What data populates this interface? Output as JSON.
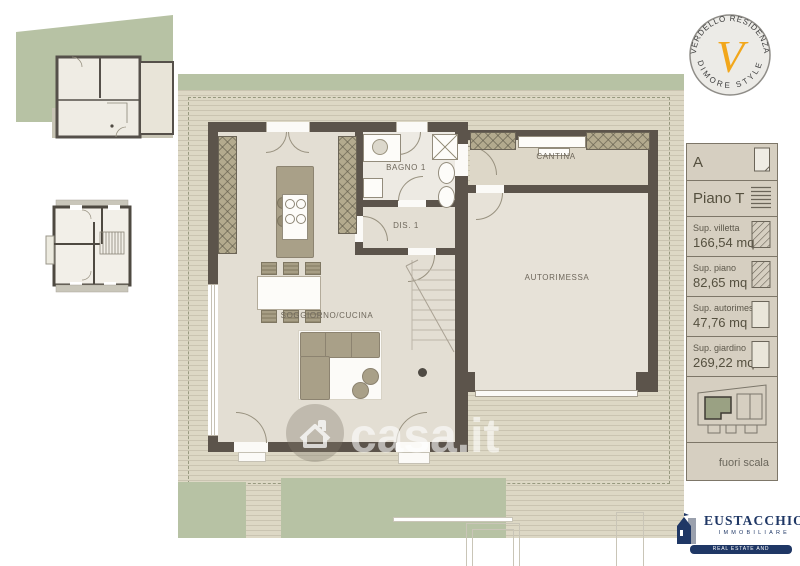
{
  "plan": {
    "labels": {
      "soggiorno": "SOGGIORNO/CUCINA",
      "bagno": "BAGNO 1",
      "dis": "DIS. 1",
      "cantina": "CANTINA",
      "autorimessa": "AUTORIMESSA"
    }
  },
  "brand_badge": {
    "top_text": "VERDELLO RESIDENZA",
    "bottom_text": "DIMORE STYLE",
    "monogram": "V",
    "monogram_color": "#F2A71B"
  },
  "info_panel": {
    "unit_label": "A",
    "floor_label": "Piano T",
    "metrics": [
      {
        "label": "Sup. villetta",
        "value": "166,54 mq"
      },
      {
        "label": "Sup. piano",
        "value": "82,65 mq"
      },
      {
        "label": "Sup. autorimessa",
        "value": "47,76 mq"
      },
      {
        "label": "Sup. giardino",
        "value": "269,22 mq"
      }
    ],
    "scale_note": "fuori scala"
  },
  "watermark": {
    "text": "casa.it"
  },
  "agency": {
    "name": "EUSTACCHIO",
    "line2": "IMMOBILIARE",
    "tagline": "REAL ESTATE AND INVESTMENTS"
  },
  "colors": {
    "garden_green": "#b7c2a4",
    "deck_beige": "#ddd8c5",
    "wall_dark": "#5c544b",
    "floor_light": "#e3ded3",
    "furniture_olive": "#a9a088",
    "panel_bg": "#d6cfc1",
    "agency_blue": "#1f3765",
    "monogram_orange": "#F2A71B"
  }
}
